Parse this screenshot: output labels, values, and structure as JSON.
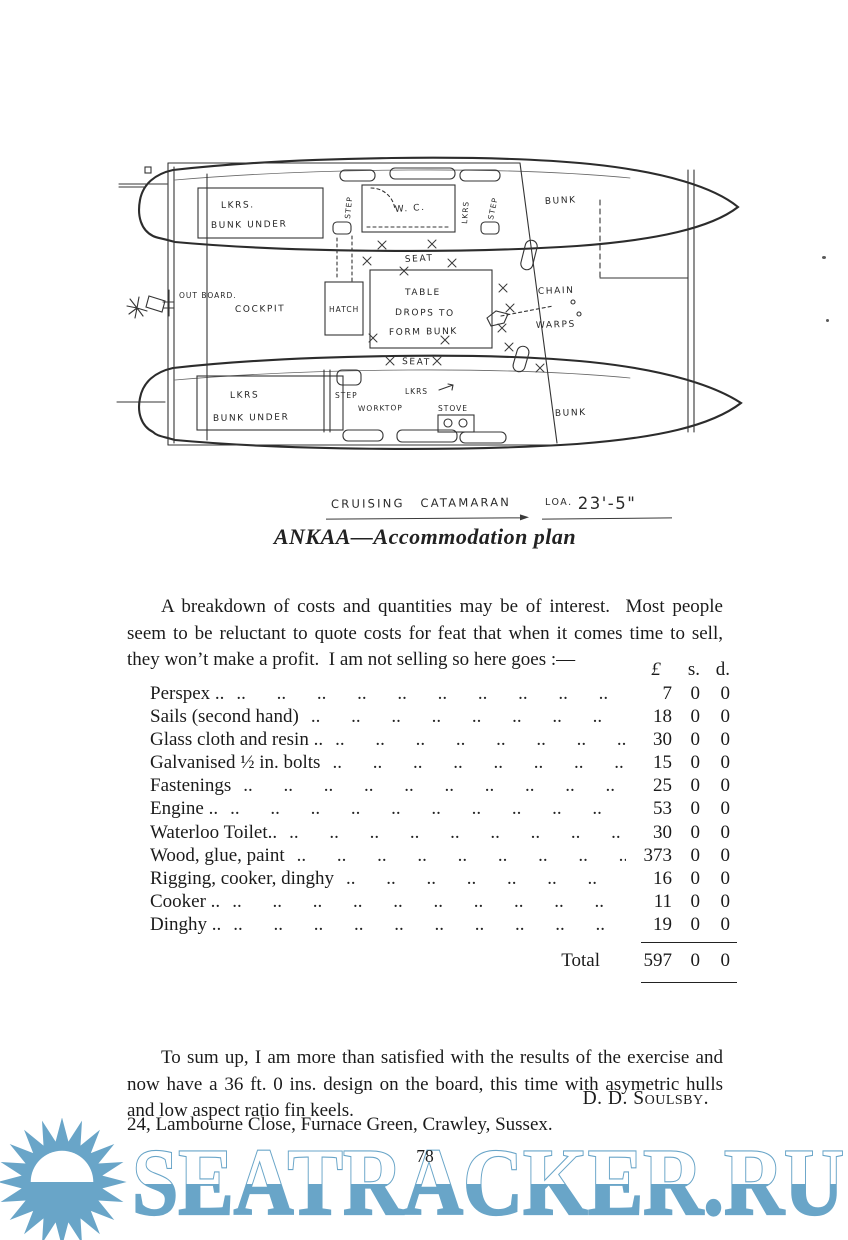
{
  "page": {
    "number": "78"
  },
  "drawing": {
    "labels": {
      "lkrs_top": "LKRS.",
      "bunk_under_top": "BUNK UNDER",
      "step_aft_top": "STEP",
      "wc": "W. C.",
      "lkrs_mid": "LKRS",
      "step_fwd_top": "STEP",
      "bunk_top": "BUNK",
      "seat_aft": "SEAT",
      "table_1": "TABLE",
      "table_2": "DROPS TO",
      "table_3": "FORM BUNK",
      "seat_fwd": "SEAT",
      "outboard": "OUT BOARD.",
      "cockpit": "COCKPIT",
      "hatch": "HATCH",
      "chain": "CHAIN",
      "warps": "WARPS",
      "lkrs_bottom": "LKRS",
      "bunk_under_bottom": "BUNK UNDER",
      "step_bottom": "STEP",
      "lkrs_bottom2": "LKRS",
      "worktop": "WORKTOP",
      "stove": "STOVE",
      "bunk_bottom": "BUNK"
    }
  },
  "caption": {
    "handwritten_title": "CRUISING CATAMARAN",
    "loa_label": "LOA.",
    "loa_value": "23'-5\"",
    "printed": "ANKAA—Accommodation plan"
  },
  "intro": "A breakdown of costs and quantities may be of interest.  Most people seem to be reluctant to quote costs for feat that when it comes time to sell, they won’t make a profit.  I am not selling so here goes :—",
  "costs": {
    "header": {
      "pound": "£",
      "shillings": "s.",
      "pence": "d."
    },
    "leader": ".. .. .. .. .. .. .. .. .. .. .. ..",
    "rows": [
      {
        "item": "Perspex ..",
        "pound": "7",
        "s": "0",
        "d": "0"
      },
      {
        "item": "Sails (second hand)",
        "pound": "18",
        "s": "0",
        "d": "0"
      },
      {
        "item": "Glass cloth and resin ..",
        "pound": "30",
        "s": "0",
        "d": "0"
      },
      {
        "item": "Galvanised ½ in. bolts",
        "pound": "15",
        "s": "0",
        "d": "0"
      },
      {
        "item": "Fastenings",
        "pound": "25",
        "s": "0",
        "d": "0"
      },
      {
        "item": "Engine ..",
        "pound": "53",
        "s": "0",
        "d": "0"
      },
      {
        "item": "Waterloo Toilet..",
        "pound": "30",
        "s": "0",
        "d": "0"
      },
      {
        "item": "Wood, glue, paint",
        "pound": "373",
        "s": "0",
        "d": "0"
      },
      {
        "item": "Rigging, cooker, dinghy",
        "pound": "16",
        "s": "0",
        "d": "0"
      },
      {
        "item": "Cooker ..",
        "pound": "11",
        "s": "0",
        "d": "0"
      },
      {
        "item": "Dinghy ..",
        "pound": "19",
        "s": "0",
        "d": "0"
      }
    ],
    "total": {
      "label": "Total",
      "pound": "597",
      "s": "0",
      "d": "0"
    }
  },
  "closing": "To sum up, I am more than satisfied with the results of the exercise and now have a 36 ft. 0 ins. design on the board, this time with asymetric hulls and low aspect ratio fin keels.",
  "signature": "D. D. Soulsby.",
  "address": "24, Lambourne Close, Furnace Green, Crawley, Sussex.",
  "watermark": {
    "text": "SEATRACKER.RU",
    "color": "#69a5c8"
  }
}
